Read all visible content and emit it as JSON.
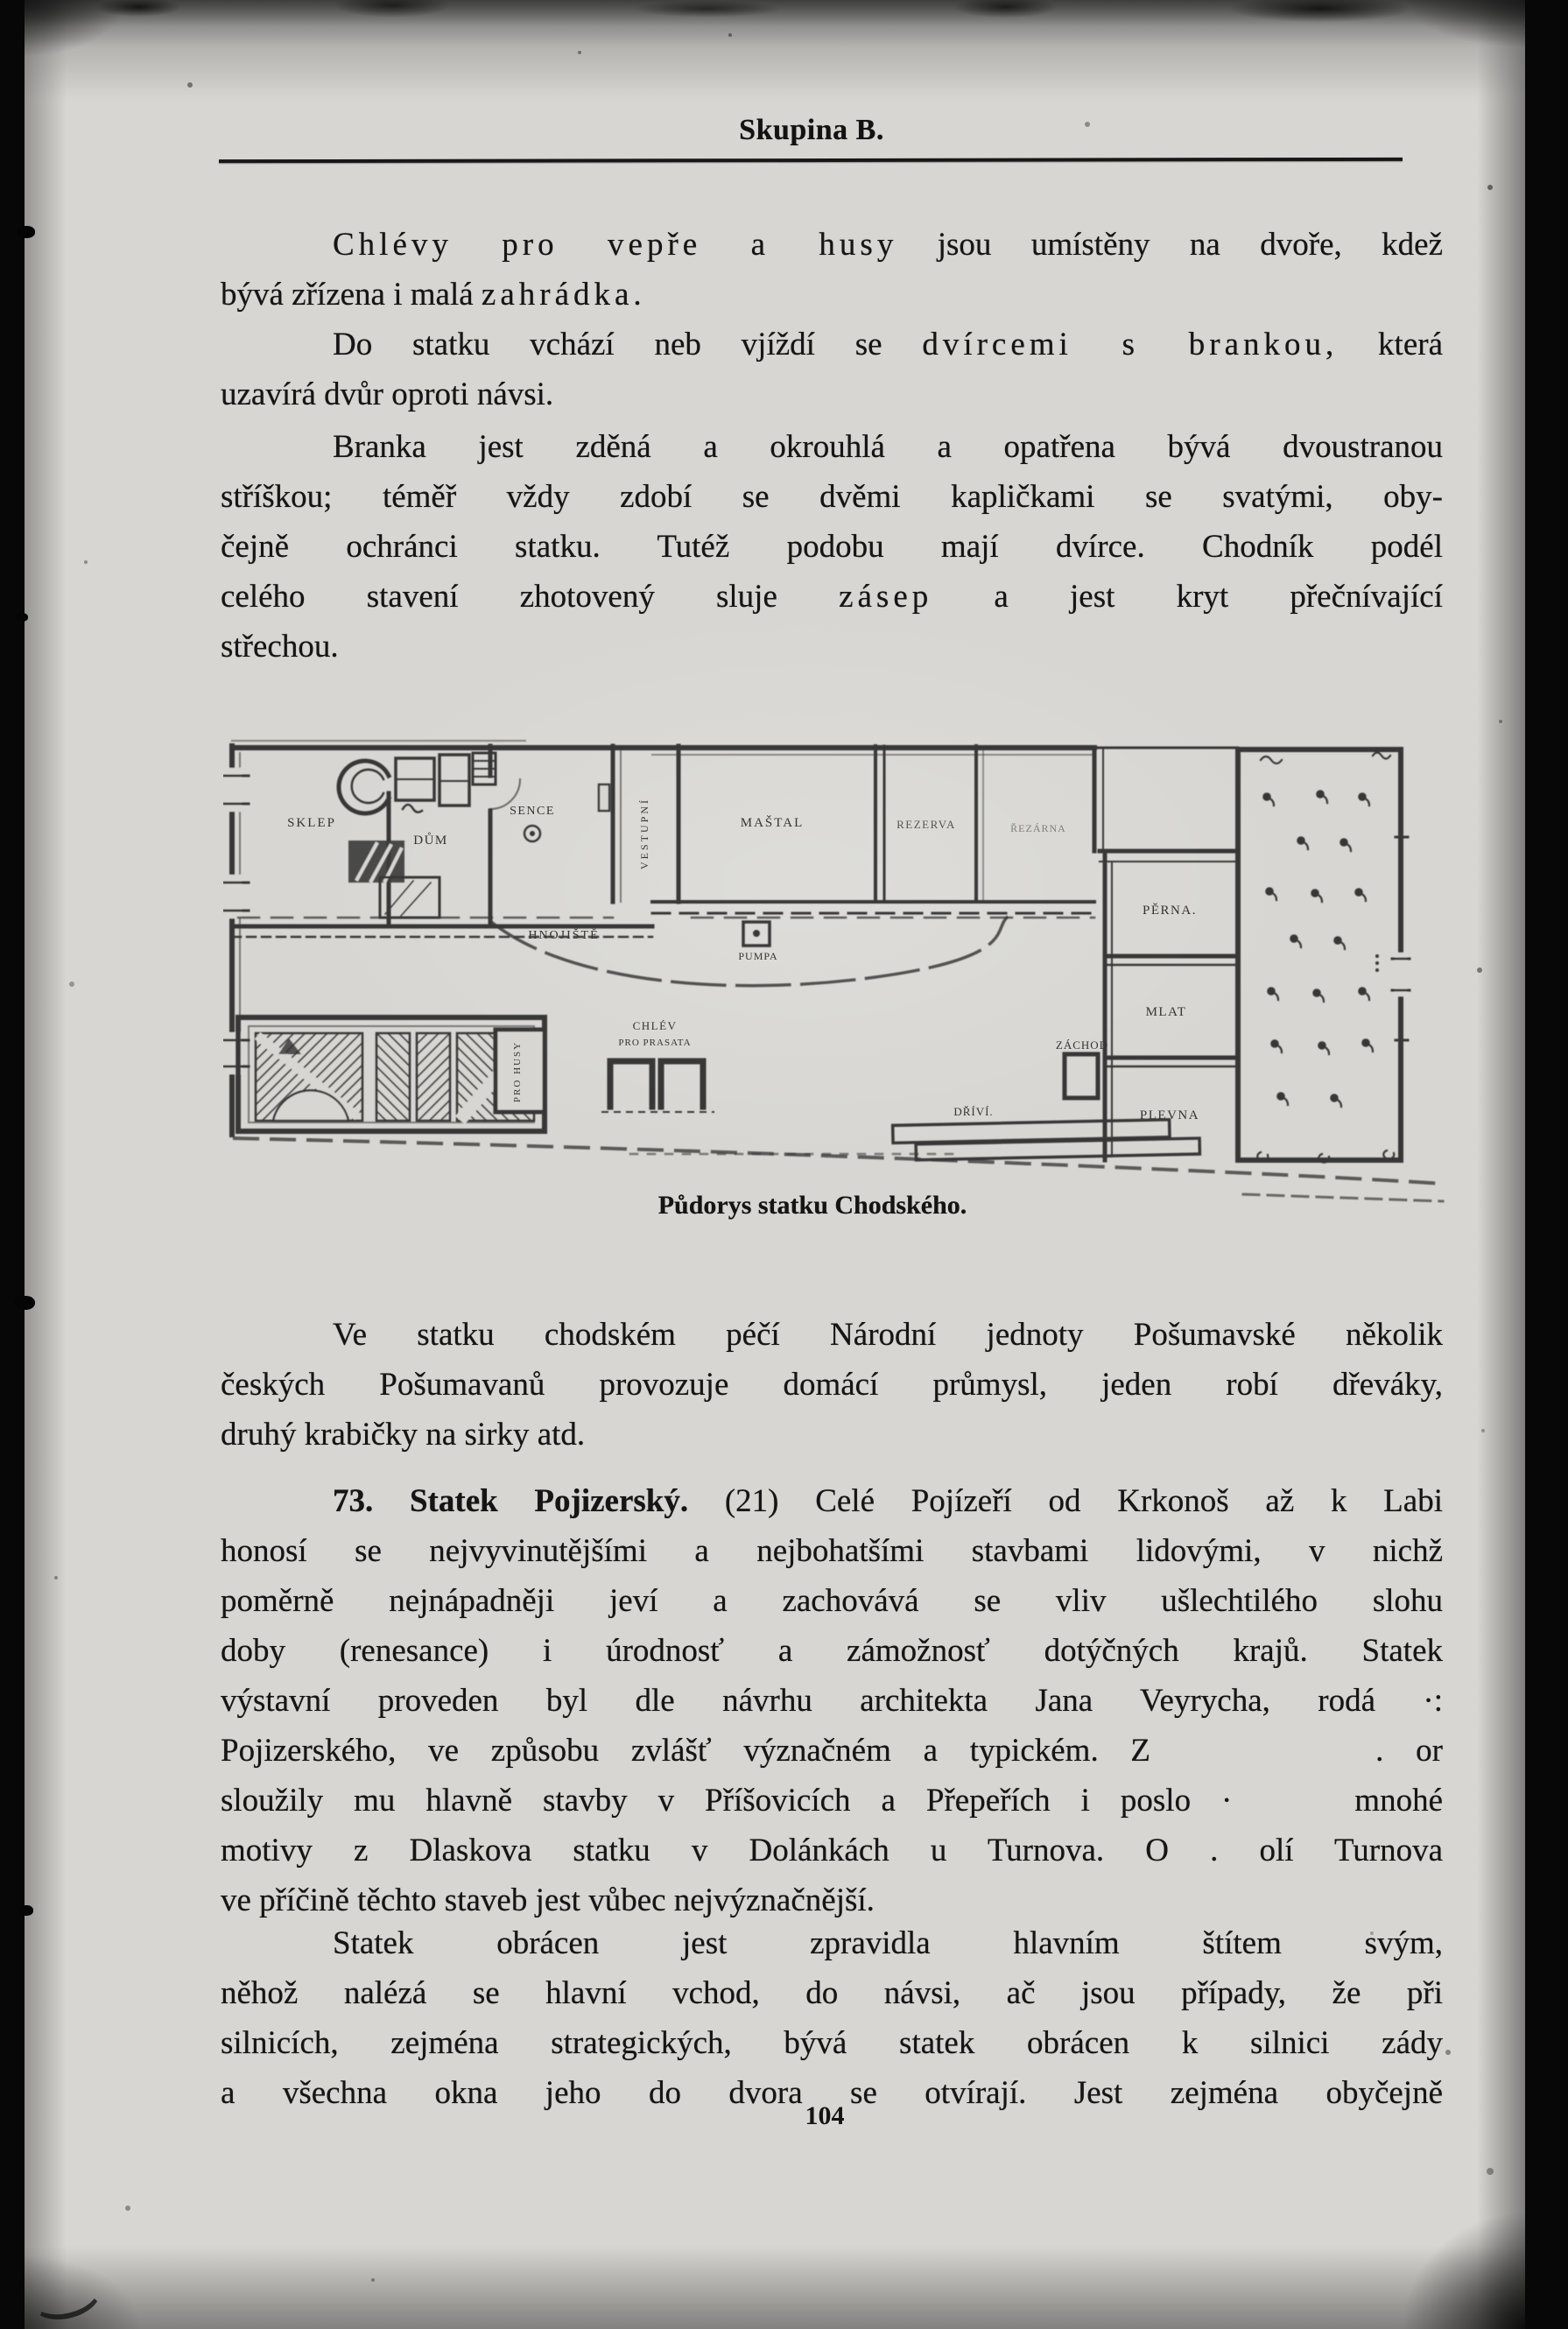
{
  "page": {
    "header": "Skupina B.",
    "page_number": "104"
  },
  "paragraphs": {
    "p1": {
      "l1a": "Chlévy pro vepře a husy",
      "l1b": " jsou umístěny na dvoře, kdež",
      "l2a": "bývá zřízena i malá ",
      "l2b": "zahrádka."
    },
    "p2": {
      "l1a": "Do statku vchází neb vjíždí se ",
      "l1b": "dvírcemi s brankou,",
      "l1c": " která",
      "l2": "uzavírá dvůr oproti návsi."
    },
    "p3": {
      "l1": "Branka jest zděná a okrouhlá a opatřena bývá dvoustranou",
      "l2": "stříškou; téměř vždy zdobí se dvěmi kapličkami se svatými, oby-",
      "l3": "čejně ochránci statku. Tutéž podobu mají dvírce. Chodník podél",
      "l4a": "celého stavení zhotovený sluje ",
      "l4b": "zásep",
      "l4c": " a jest kryt přečnívající",
      "l5": "střechou."
    },
    "p4": {
      "l1": "Ve statku chodském péčí Národní jednoty Pošumavské několik",
      "l2": "českých Pošumavanů provozuje domácí průmysl, jeden robí dřeváky,",
      "l3": "druhý krabičky na sirky atd."
    },
    "p5": {
      "l1a": "73. Statek Pojizerský.",
      "l1b": " (21) Celé Pojízeří od Krkonoš až k Labi",
      "l2": "honosí se nejvyvinutějšími a nejbohatšími stavbami lidovými, v nichž",
      "l3": "poměrně nejnápadněji jeví a zachovává se vliv ušlechtilého slohu",
      "l4": "doby (renesance) i úrodnosť a zámožnosť dotýčných krajů. Statek",
      "l5": "výstavní proveden byl dle návrhu architekta Jana Veyrycha, rodá ·:",
      "l6": "Pojizerského, ve způsobu zvlášť význačném a typickém. Z       . or",
      "l7": "sloužily mu hlavně stavby v Příšovicích a Přepeřích i poslo ·    mnohé",
      "l8": "motivy z Dlaskova statku v Dolánkách u Turnova. O . olí Turnova",
      "l9": "ve příčině těchto staveb jest vůbec nejvýznačnější."
    },
    "p6": {
      "l1": "Statek obrácen jest zpravidla hlavním štítem svým,",
      "l2": "něhož nalézá se hlavní vchod, do návsi, ač jsou případy, že při",
      "l3": "silnicích, zejména strategických, bývá statek obrácen k silnici zády",
      "l4": "a všechna okna jeho do dvora se otvírají. Jest zejména obyčejně"
    }
  },
  "figure": {
    "caption": "Půdorys statku Chodského.",
    "labels": {
      "sklep": "SKLEP",
      "dum": "DŮM",
      "sence": "SENCE",
      "vestupni": "VESTUPNÍ",
      "mastal": "MAŠTAL",
      "rezerva": "REZERVA",
      "rezarna": "ŘEZÁRNA",
      "perna": "PĚRNA.",
      "mlat": "MLAT",
      "plevna": "PLEVNA",
      "hnojiste": "HNOJIŠTĚ",
      "pumpa": "PUMPA",
      "chlev_line1": "CHLÉV",
      "chlev_line2": "PRO PRASATA",
      "zachod": "ZÁCHOD",
      "drivi": "DŘÍVÍ.",
      "pro_husy": "PRO HUSY"
    }
  }
}
